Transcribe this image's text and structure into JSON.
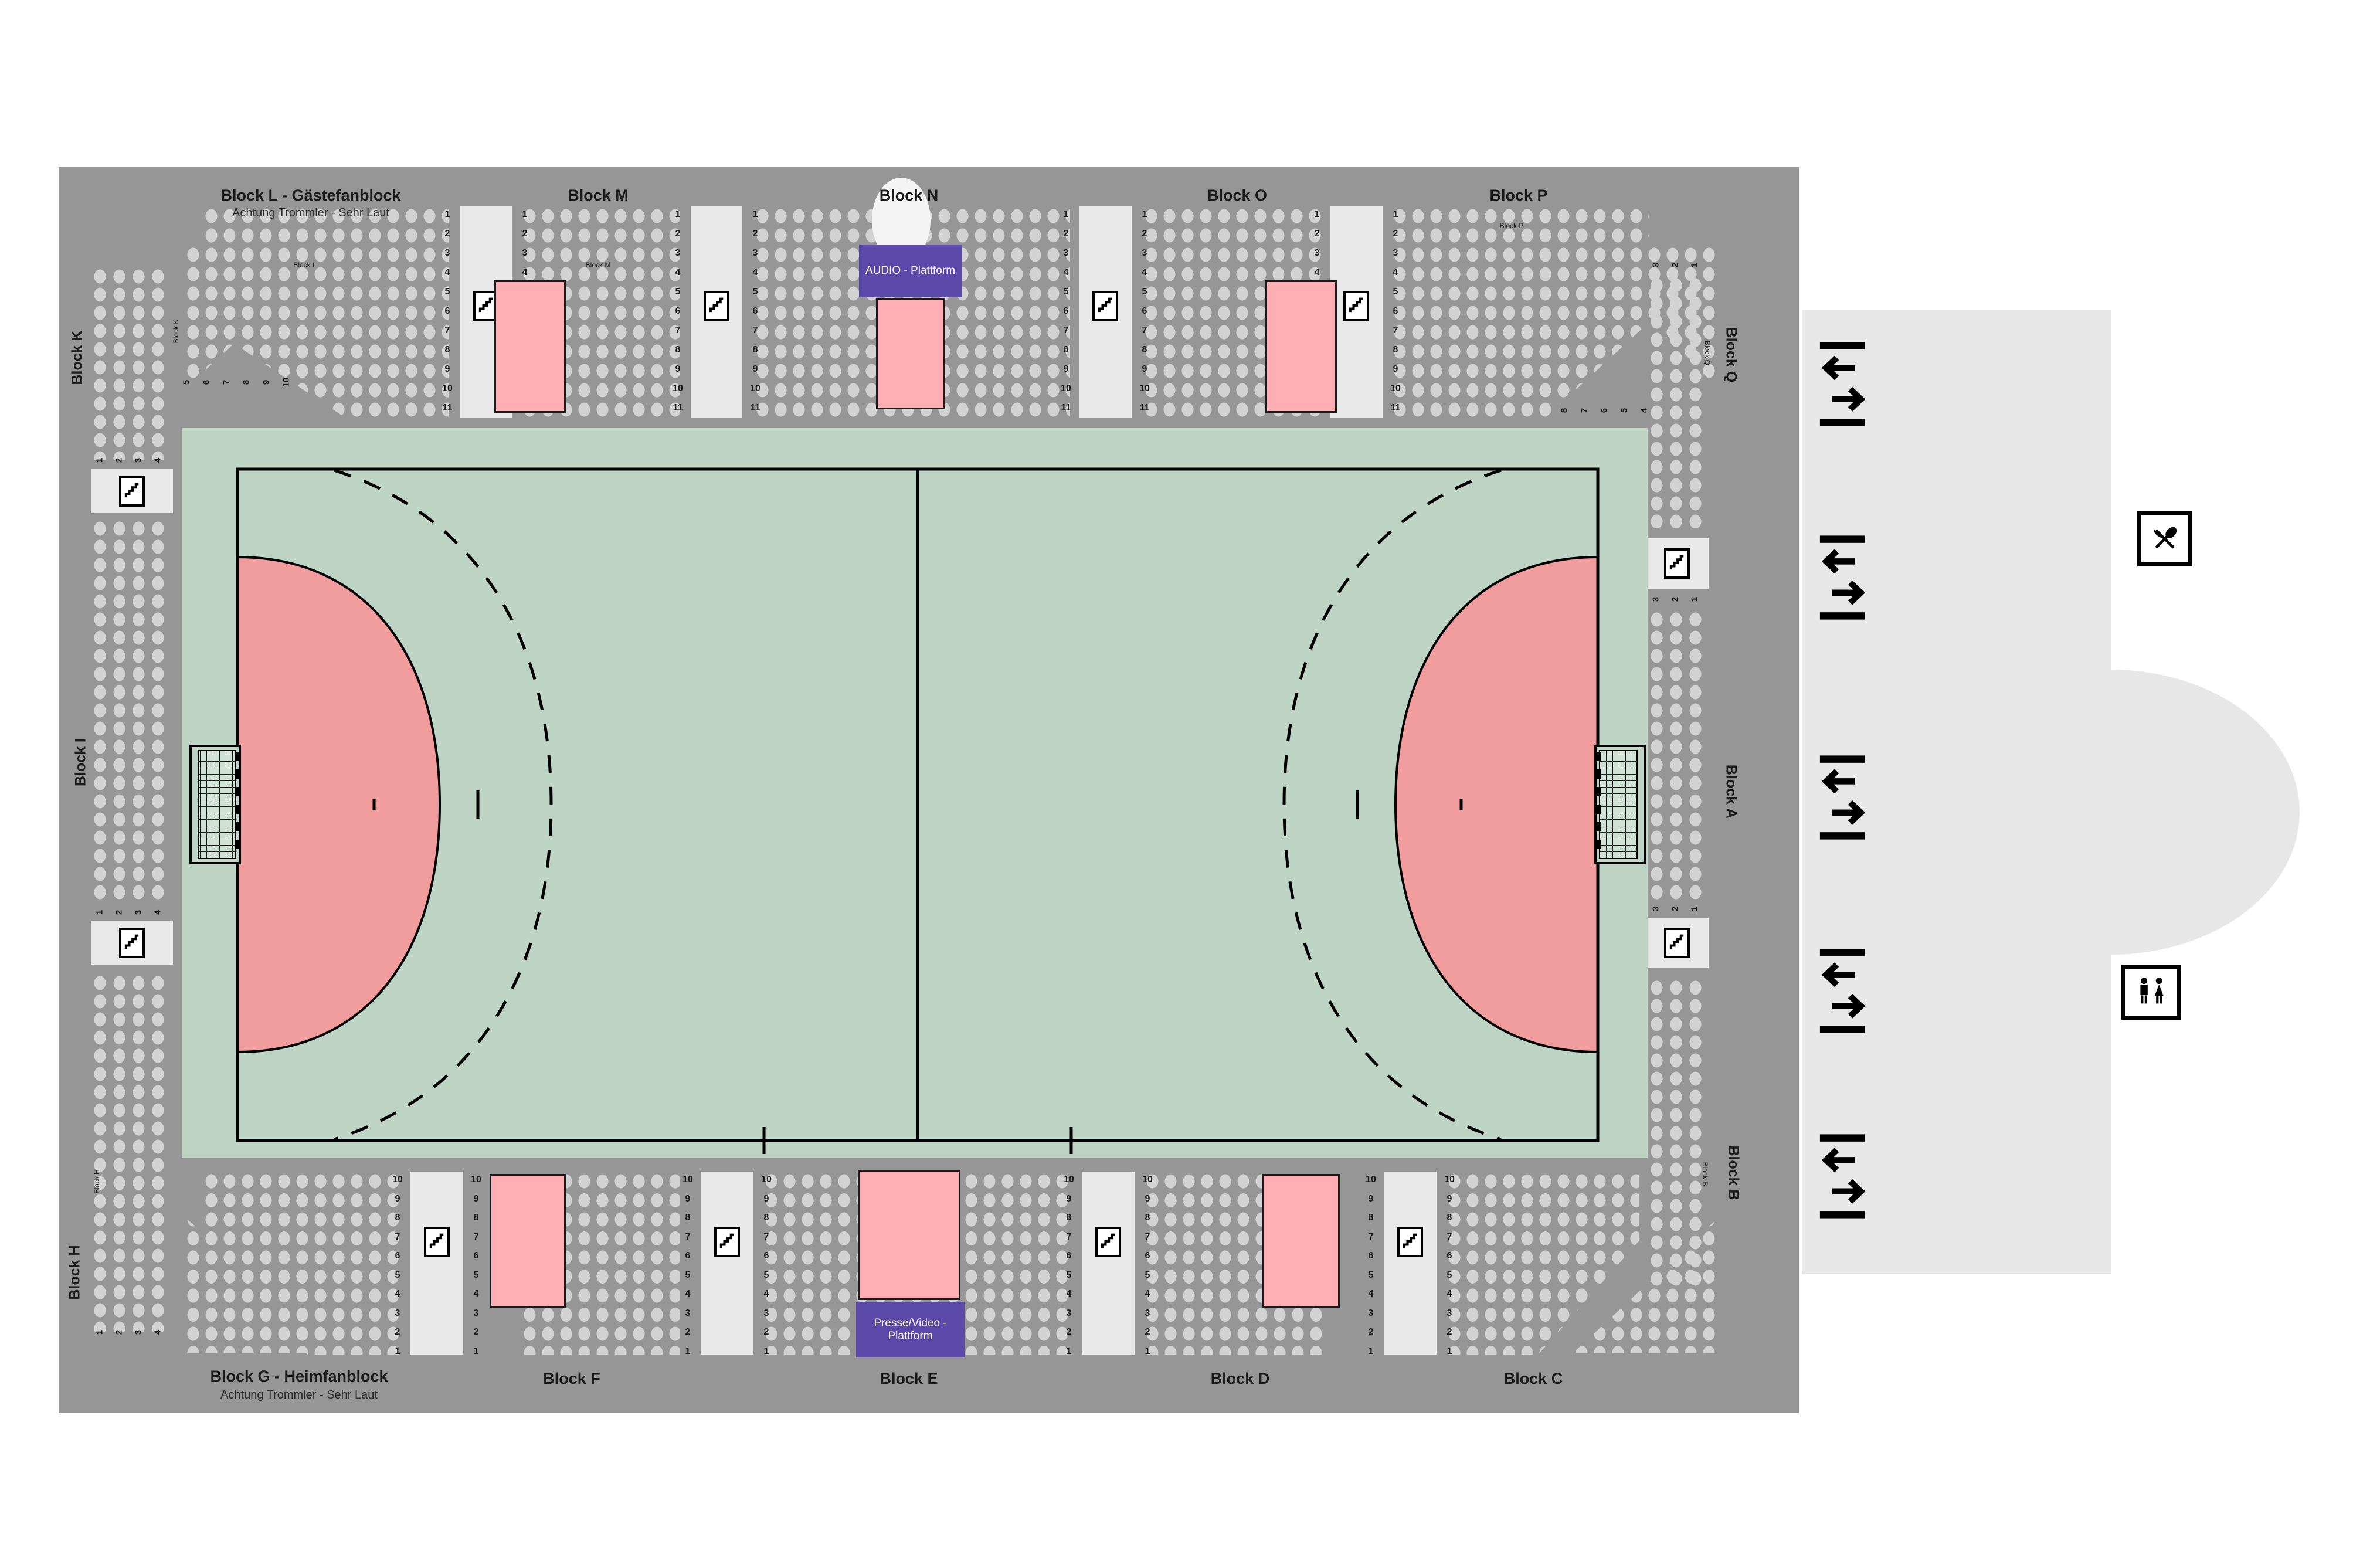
{
  "colors": {
    "arena_bg": "#969696",
    "seat_dot": "#d2d2d2",
    "court_green": "#bed5c5",
    "goal_area_red": "#f19d9d",
    "standing_pink": "#ffafb4",
    "platform_purple": "#5a49a8",
    "corridor_gray": "#e9e9e9",
    "foyer_gray": "#e7e7e7"
  },
  "stands": {
    "top": {
      "blocks": [
        {
          "title": "Block L - Gästefanblock",
          "subtitle": "Achtung Trommler - Sehr Laut"
        },
        {
          "title": "Block M"
        },
        {
          "title": "Block N"
        },
        {
          "title": "Block O"
        },
        {
          "title": "Block P"
        }
      ],
      "row_numbers": [
        "1",
        "2",
        "3",
        "4",
        "5",
        "6",
        "7",
        "8",
        "9",
        "10",
        "11"
      ]
    },
    "bottom": {
      "blocks": [
        {
          "title": "Block G - Heimfanblock",
          "subtitle": "Achtung Trommler - Sehr Laut"
        },
        {
          "title": "Block F"
        },
        {
          "title": "Block E"
        },
        {
          "title": "Block D"
        },
        {
          "title": "Block C"
        }
      ],
      "row_numbers": [
        "10",
        "9",
        "8",
        "7",
        "6",
        "5",
        "4",
        "3",
        "2",
        "1"
      ]
    },
    "left": {
      "labels": [
        "Block K",
        "Block I",
        "Block H"
      ],
      "column_numbers": [
        "1",
        "2",
        "3",
        "4"
      ],
      "corner_numbers": [
        "5",
        "6",
        "7",
        "8",
        "9",
        "10"
      ]
    },
    "right": {
      "labels": [
        "Block Q",
        "Block A",
        "Block B"
      ],
      "column_numbers": [
        "3",
        "2",
        "1"
      ],
      "corner_numbers": [
        "8",
        "7",
        "6",
        "5",
        "4"
      ]
    }
  },
  "inner_labels": {
    "block_l": "Block L",
    "block_m": "Block M",
    "block_p": "Block P",
    "block_k": "Block K",
    "block_h": "Block H",
    "block_q": "Block Q",
    "block_b": "Block B"
  },
  "platforms": {
    "audio": "AUDIO - Plattform",
    "press": "Presse/Video - Plattform"
  },
  "icons": {
    "stairs": "stairs",
    "door": "entrance-exit",
    "restaurant": "restaurant",
    "wc": "wc-toilets"
  }
}
